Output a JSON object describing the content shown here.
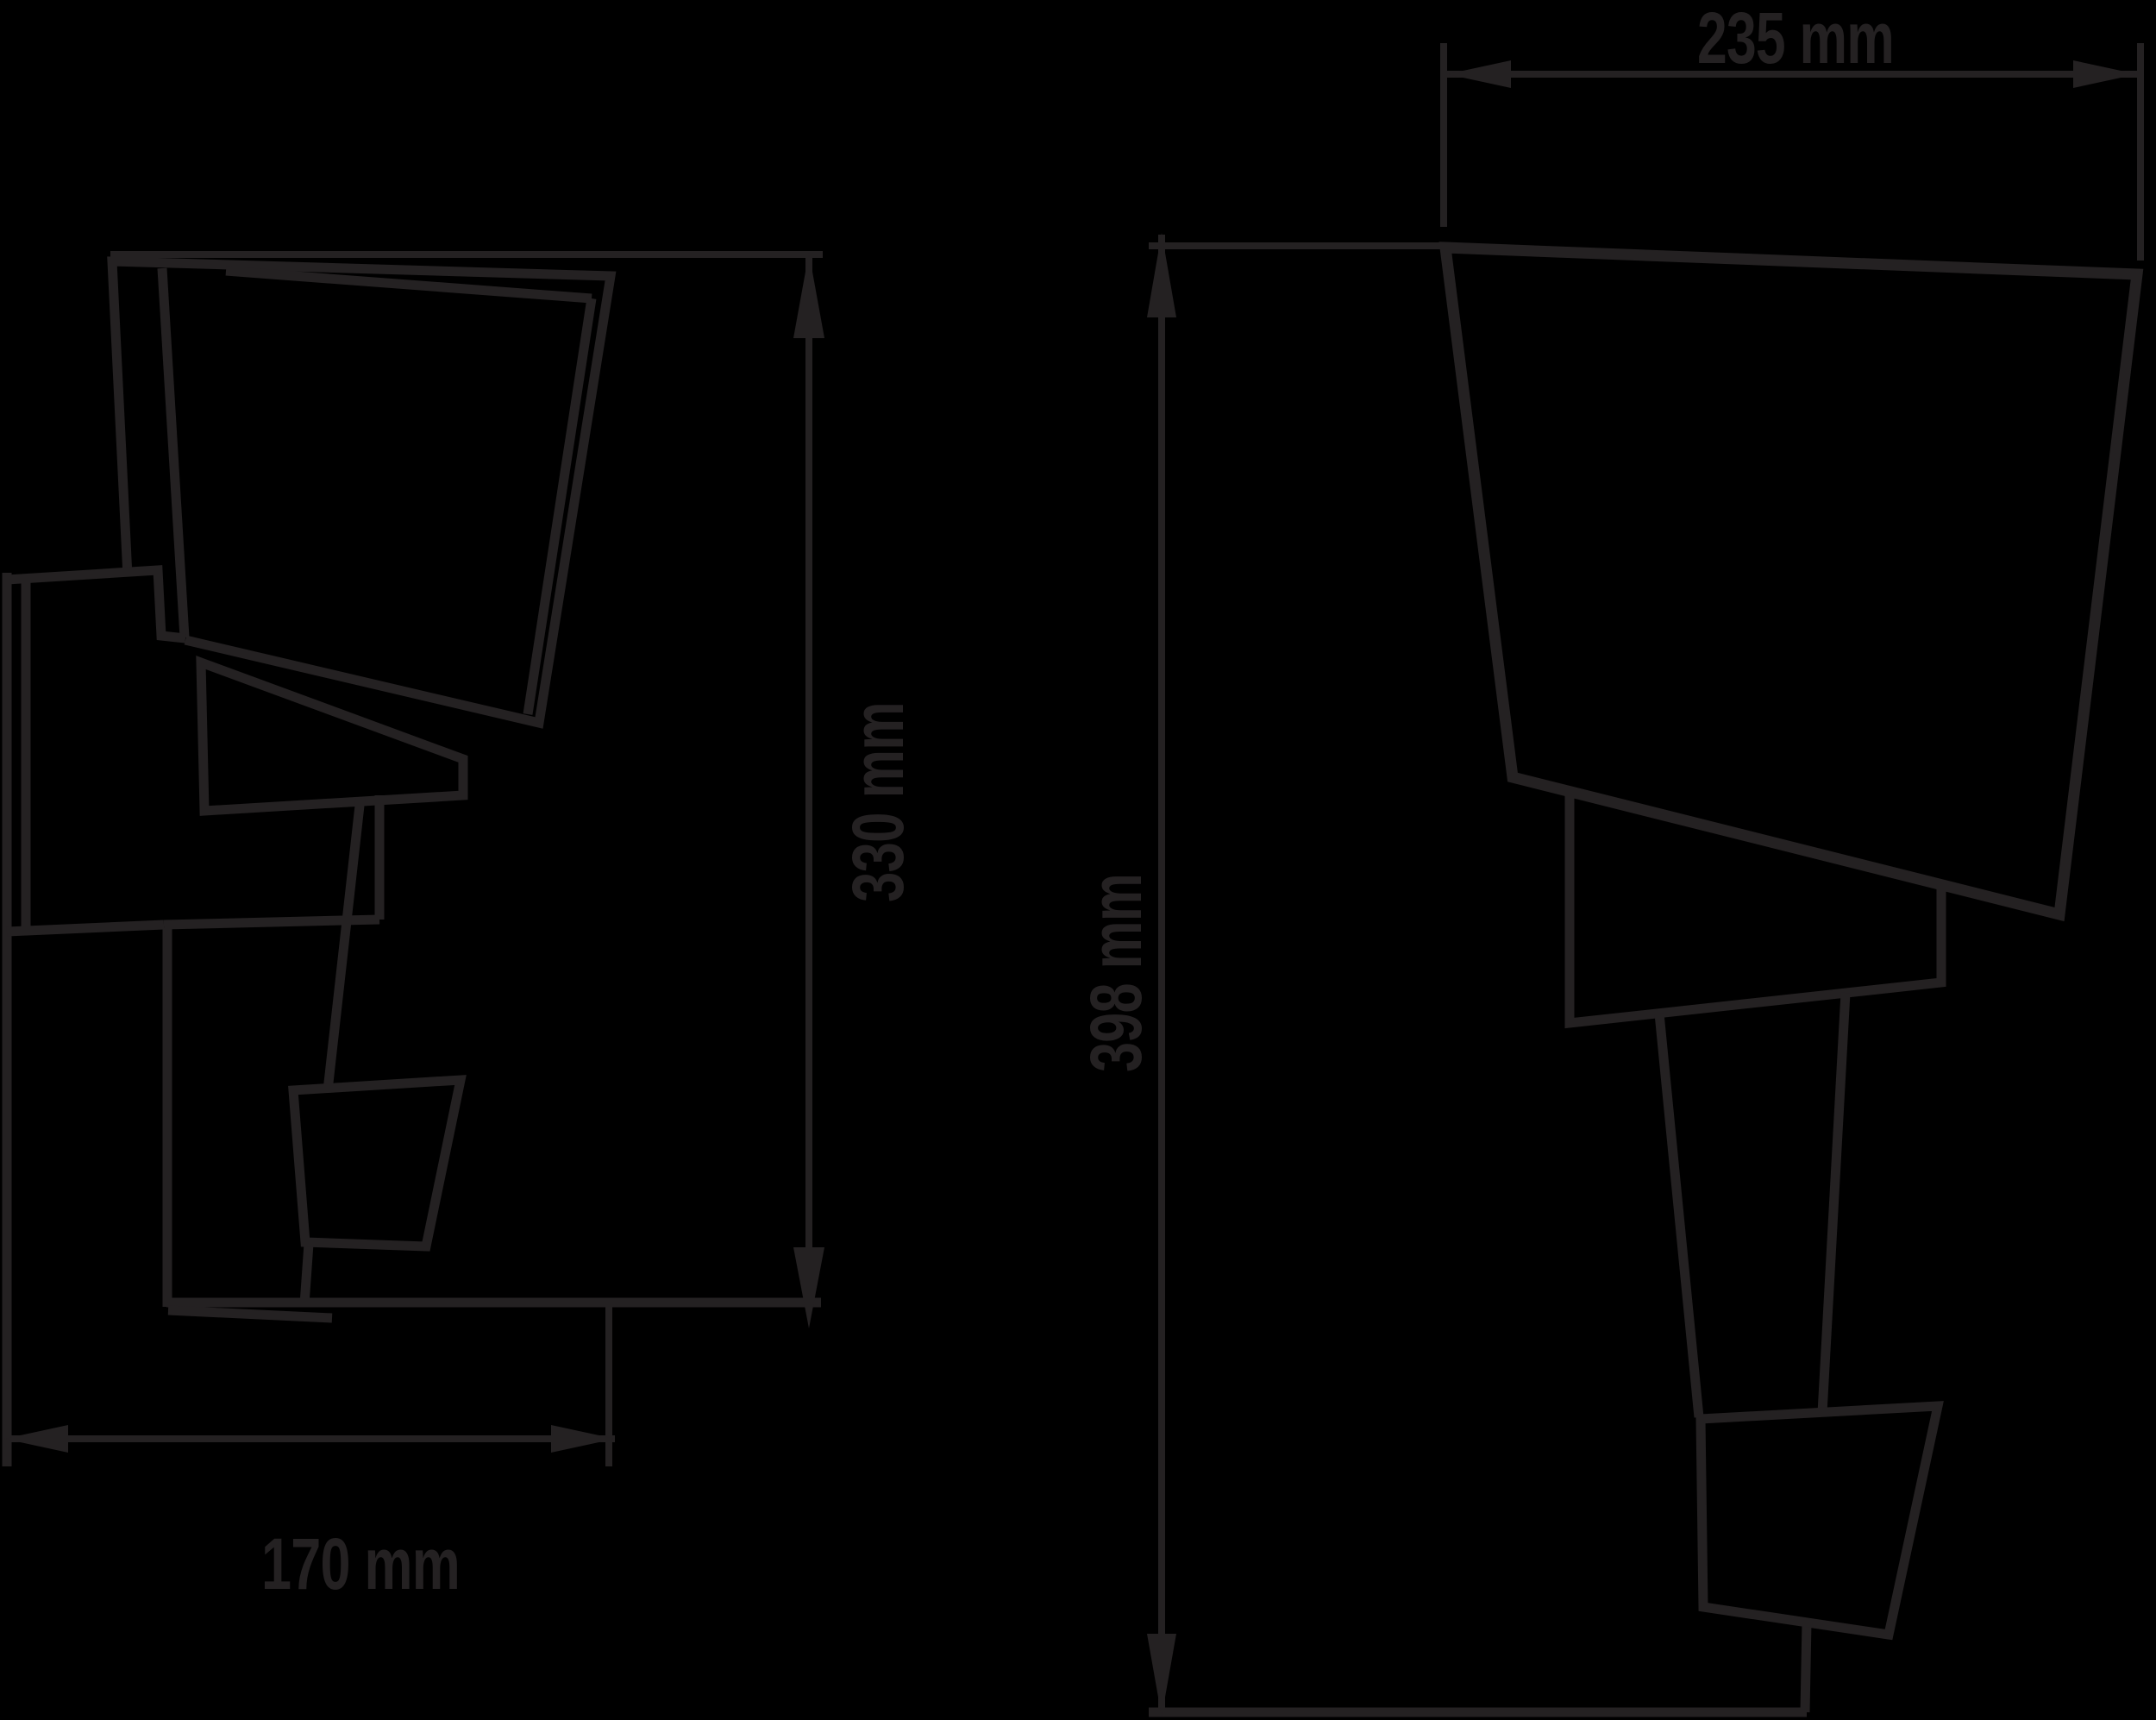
{
  "colors": {
    "background": "#000000",
    "line": "#242122"
  },
  "drawing": {
    "description": "Two-view technical line drawing of a faceted folded-sheet wall lamp",
    "views": {
      "left": "side view",
      "right": "front view"
    },
    "dimensions": {
      "depth_side": {
        "label": "170 mm",
        "value": 170,
        "unit": "mm"
      },
      "height_side": {
        "label": "330 mm",
        "value": 330,
        "unit": "mm"
      },
      "width_front": {
        "label": "235 mm",
        "value": 235,
        "unit": "mm"
      },
      "height_front": {
        "label": "398 mm",
        "value": 398,
        "unit": "mm"
      }
    }
  }
}
